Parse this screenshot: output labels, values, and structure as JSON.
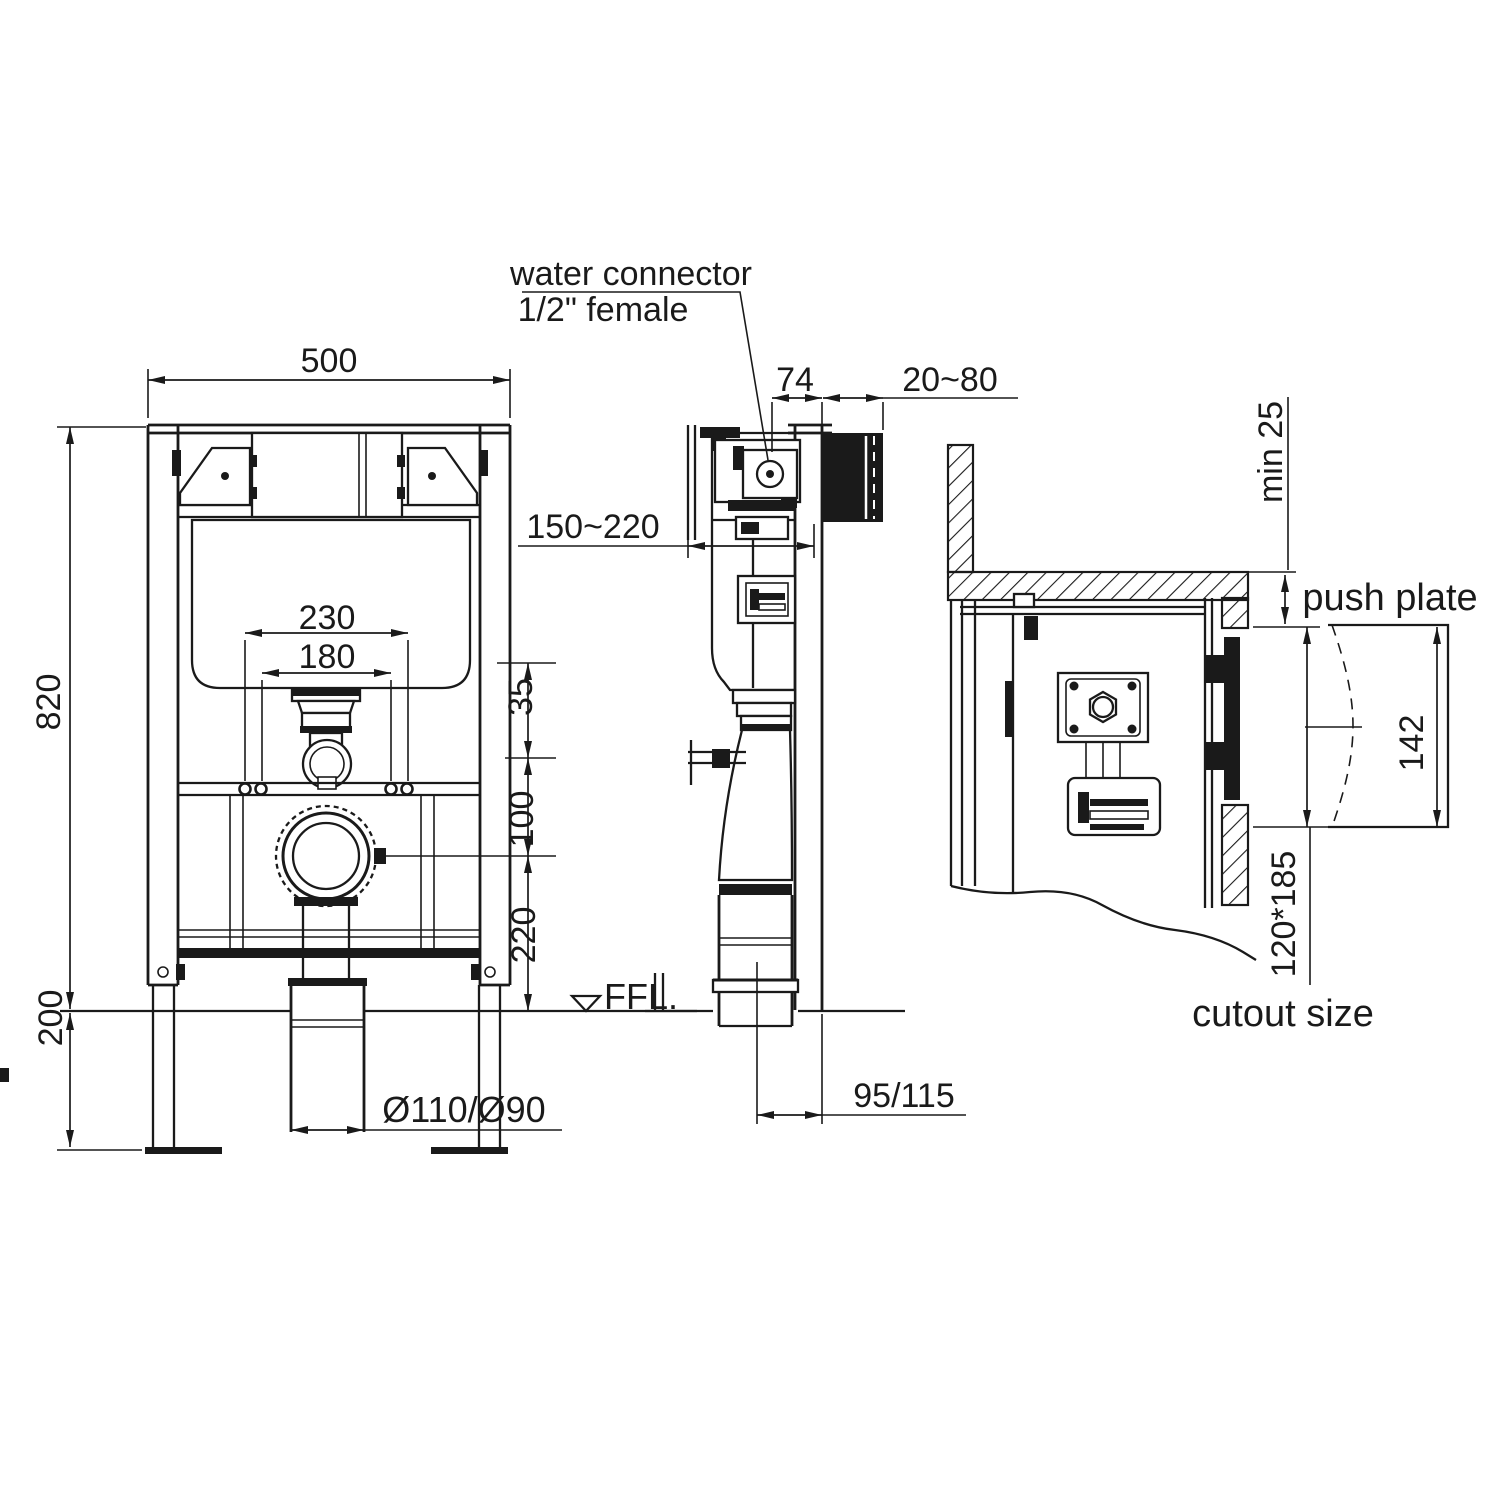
{
  "drawing": {
    "colors": {
      "ink": "#1a1a1a",
      "paper": "#ffffff"
    },
    "callout": {
      "water_connector_line1": "water connector",
      "water_connector_line2": "1/2\" female"
    },
    "front": {
      "overall_width": "500",
      "overall_height": "820",
      "leg_height": "200",
      "bracket_spacing_outer": "230",
      "bracket_spacing_inner": "180",
      "cistern_to_flush_gap": "35",
      "flush_to_drain": "100",
      "drain_to_floor": "220",
      "floor_level_label": "FFL.",
      "drain_pipe_diameter": "Ø110/Ø90"
    },
    "side": {
      "connector_offset": "74",
      "wall_finish_range": "20~80",
      "flush_depth_range": "150~220",
      "drain_center_offset": "95/115"
    },
    "section": {
      "min_cover": "min 25",
      "push_plate_label": "push plate",
      "push_plate_height": "142",
      "cutout_dimensions": "120*185",
      "cutout_label": "cutout size"
    }
  }
}
